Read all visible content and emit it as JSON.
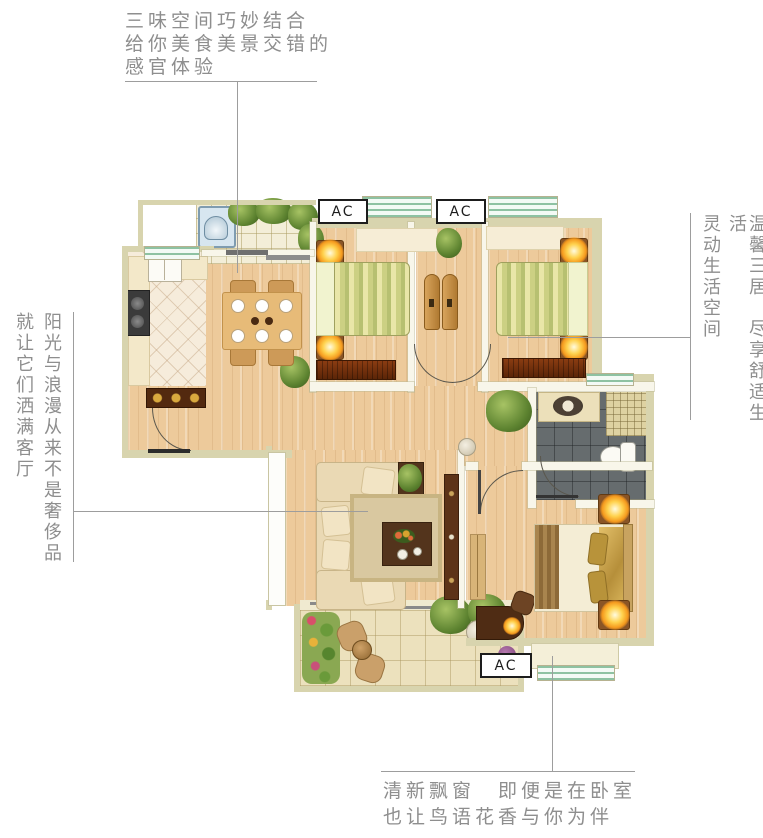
{
  "annotations": {
    "top": {
      "line1": "三味空间巧妙结合",
      "line2": "给你美食美景交错的",
      "line3": "感官体验"
    },
    "left": {
      "col_inner": "阳光与浪漫从来不是奢侈品",
      "col_outer": "就让它们洒满客厅"
    },
    "right": {
      "col_outer": "温馨三居　尽享舒适生活",
      "col_inner": "灵动生活空间"
    },
    "bottom": {
      "line1": "清新飘窗　即便是在卧室",
      "line2": "也让鸟语花香与你为伴"
    }
  },
  "plan": {
    "ac_label": "AC"
  },
  "colors": {
    "wall": "#d8d4ae",
    "wood_floor": "#edca9b",
    "window_green": "#8ec2a2",
    "bath_tile": "#666c6e",
    "lamp_glow": "#f59a1e",
    "annotation_text": "#8e8e8e",
    "leader_line": "#9d9d9d"
  }
}
